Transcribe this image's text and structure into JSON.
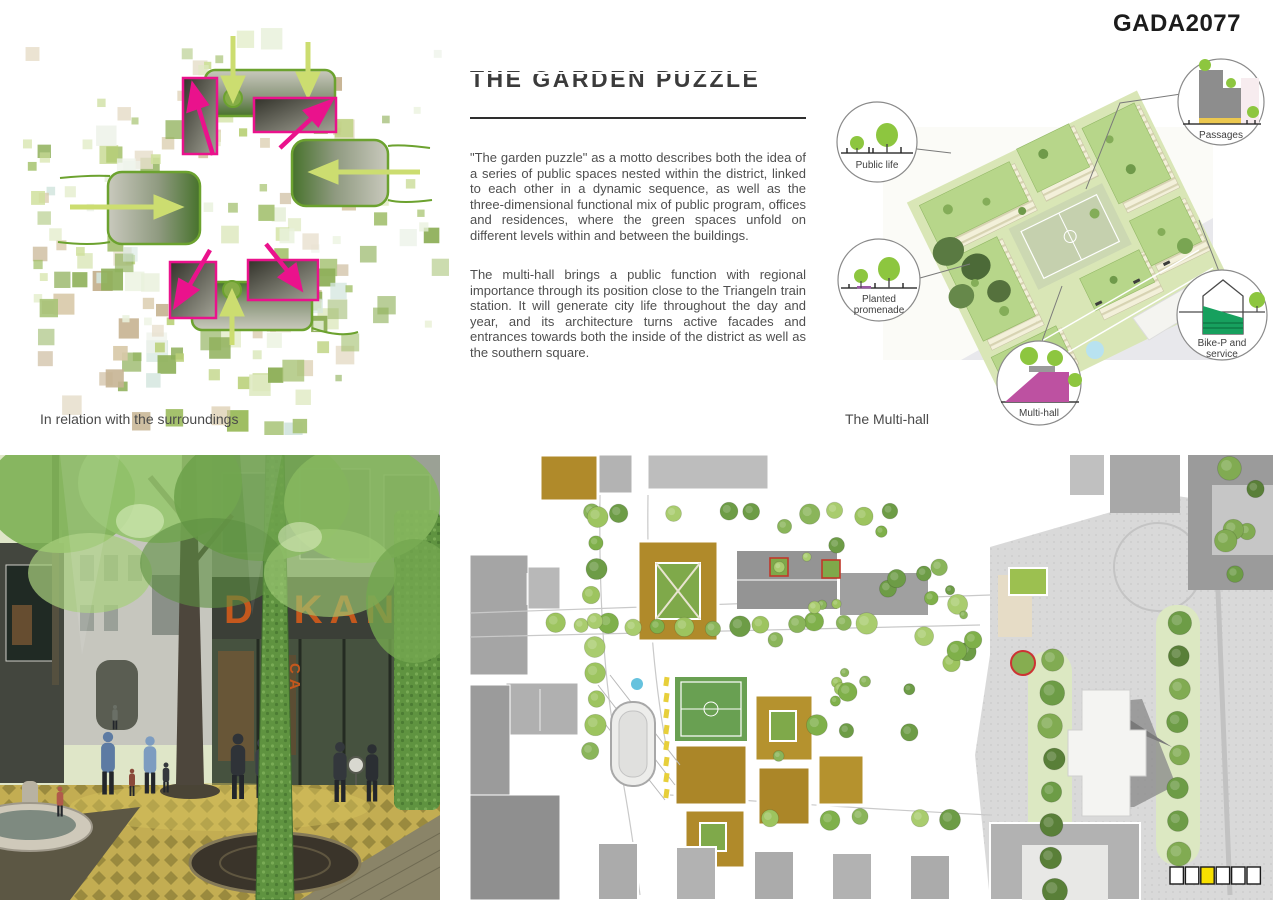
{
  "header": {
    "project_code": "GADA2077"
  },
  "relation_diagram": {
    "caption": "In relation with the surroundings"
  },
  "article": {
    "title": "THE GARDEN PUZZLE",
    "paragraph_1": "\"The garden puzzle\" as a motto describes both the idea of a series of public spaces nested within the district, linked to each other in a dynamic sequence, as well as the three-dimensional functional mix of public program, offices and residences, where the green spaces unfold on different levels within and between the buildings.",
    "paragraph_2": "The multi-hall brings a public function with regional importance through its position close to the Triangeln train station. It will generate city life throughout the day and year, and its architecture turns active facades and entrances towards both the inside of the district as well as the southern square."
  },
  "axonometric": {
    "caption": "The Multi-hall",
    "callouts": {
      "public_life": "Public life",
      "planted_line1": "Planted",
      "planted_line2": "promenade",
      "multi_hall": "Multi-hall",
      "passages": "Passages",
      "bike_p_line1": "Bike-P and",
      "bike_p_line2": "service"
    }
  },
  "street_render": {
    "sign_text": "DEKANEN",
    "sign_side_text": "CA"
  },
  "site_plan": {
    "page_indicator": {
      "total": 6,
      "active": 3,
      "active_color": "#f8e000"
    }
  },
  "colors": {
    "accent_magenta": "#ea128c",
    "gate_green": "#6ca22f",
    "arrow_light_green": "#ccdd70",
    "tree_green": "#8dc63f",
    "ochre_roof": "#b08a2a",
    "service_green": "#17a05e"
  }
}
